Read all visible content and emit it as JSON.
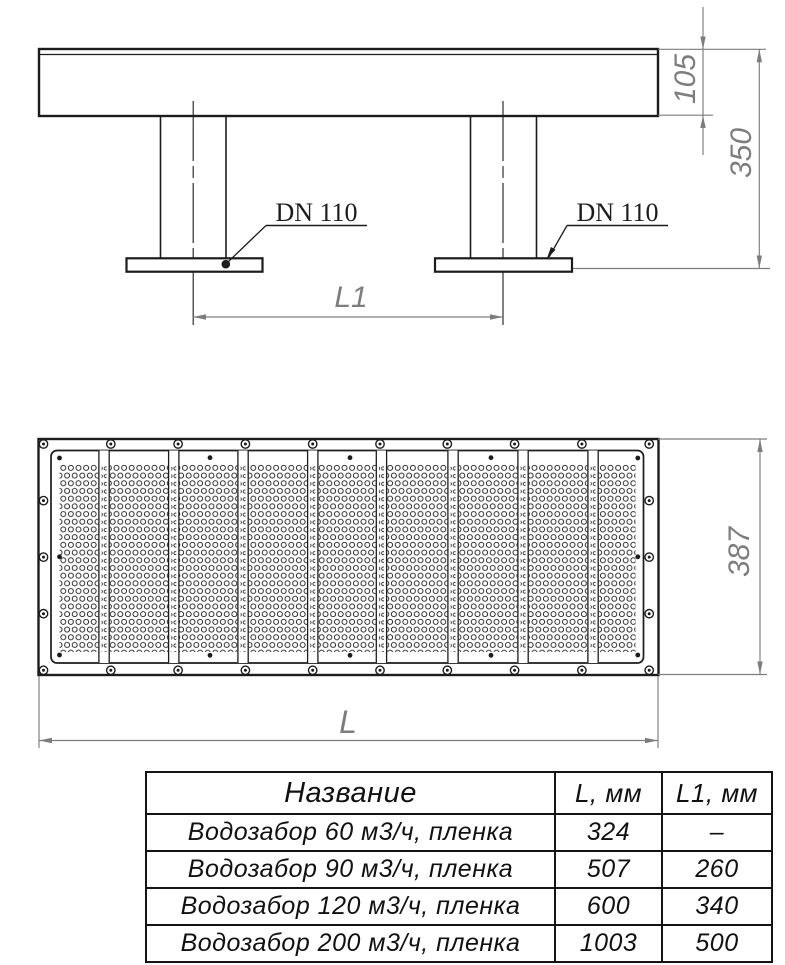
{
  "drawing": {
    "side_view": {
      "dn_label_left": "DN 110",
      "dn_label_right": "DN 110",
      "dim_body_height": "105",
      "dim_total_height": "350",
      "dim_leg_spacing": "L1"
    },
    "plan_view": {
      "dim_plate_width": "387",
      "dim_plate_length": "L"
    },
    "colors": {
      "line": "#1c1c1c",
      "dimension": "#7d7d7d",
      "background": "#ffffff"
    }
  },
  "table": {
    "headers": [
      "Название",
      "L, мм",
      "L1, мм"
    ],
    "rows": [
      [
        "Водозабор 60 м3/ч, пленка",
        "324",
        "–"
      ],
      [
        "Водозабор 90 м3/ч, пленка",
        "507",
        "260"
      ],
      [
        "Водозабор 120 м3/ч, пленка",
        "600",
        "340"
      ],
      [
        "Водозабор 200 м3/ч, пленка",
        "1003",
        "500"
      ]
    ]
  }
}
